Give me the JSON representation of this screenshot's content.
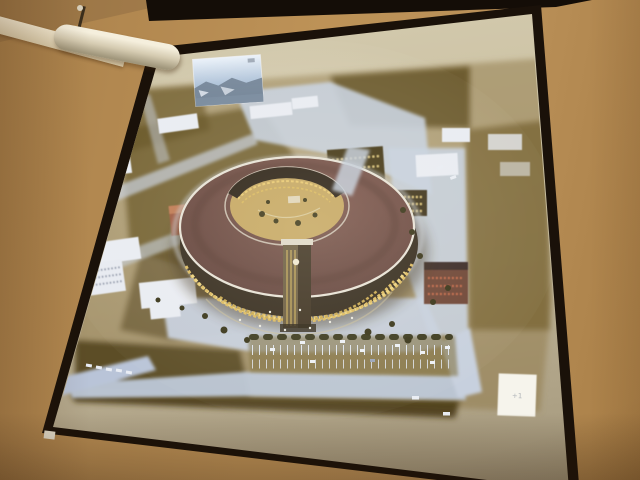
{
  "scene": {
    "type": "photograph",
    "subject": "projection screen in a conference room showing an architectural aerial rendering",
    "slide_subject": "ring-shaped building complex at dusk with illuminated golden windows, clock tower, plaza, parking lot and surrounding city blocks",
    "inset_thumbnail": "small sky-and-mountains picture at upper left of slide",
    "corner_box_mark": "+1"
  },
  "colors": {
    "wall_tan": "#b58b52",
    "molding_cream": "#f0e6cc",
    "frame_black": "#1a1109",
    "screen_top": "#d3caae",
    "screen_bottom": "#a09478",
    "slide_sepia": "#8f7845",
    "slide_dark_olive": "#5e4b24",
    "street_light": "#c7d0de",
    "roof_maroon": "#6e4a42",
    "window_gold": "#dcba60",
    "courtyard_gold": "#c5a660",
    "brick_red": "#a05a40",
    "car_white": "#eef1f6",
    "tree_dark": "#3c3a1e",
    "sky_blue": "#a9bed6"
  }
}
